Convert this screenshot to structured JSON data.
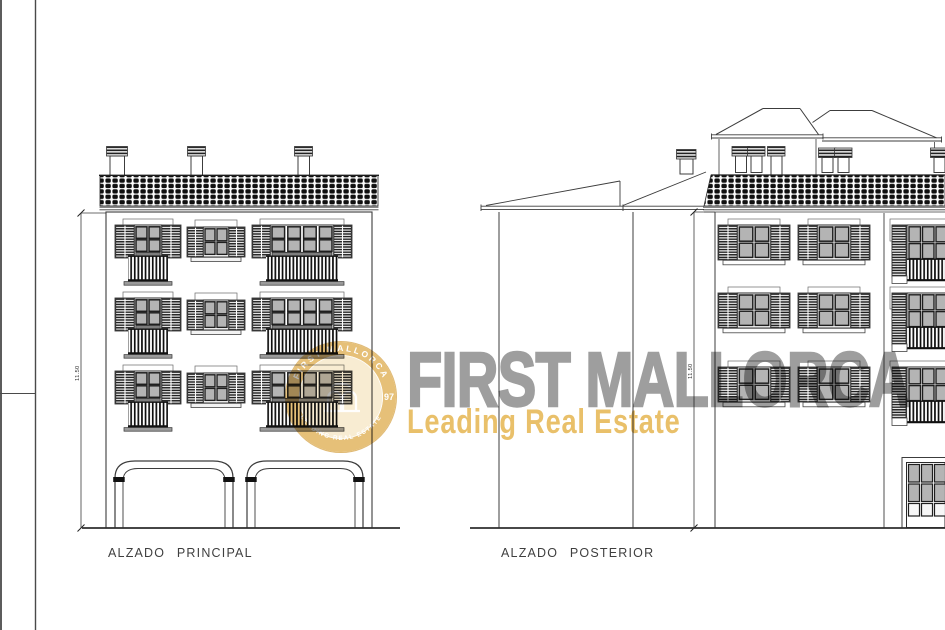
{
  "document": {
    "type": "architectural elevation drawing",
    "background": "#ffffff",
    "ink_color": "#3c3c3c",
    "glass_color": "#b4b4b4"
  },
  "elevations": {
    "principal": {
      "label": "ALZADO PRINCIPAL",
      "height_dimension": "11.50"
    },
    "posterior": {
      "label": "ALZADO POSTERIOR",
      "height_dimension": "11.50"
    }
  },
  "watermark": {
    "brand": "FIRST MALLORCA",
    "tagline": "Leading Real Estate",
    "brand_color": "#9e9e9e",
    "tagline_color": "#e9c06a",
    "seal": {
      "arc_top": "FIRST MALLORCA",
      "arc_bottom": "LEADING REAL ESTATE",
      "year": "97",
      "gold": "#e2b765"
    }
  }
}
